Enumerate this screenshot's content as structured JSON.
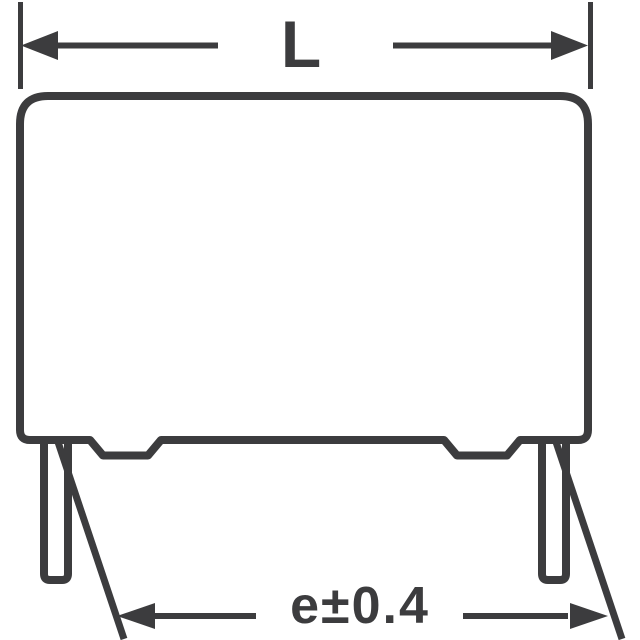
{
  "colors": {
    "line": "#3c3c3e",
    "background": "#ffffff"
  },
  "dimensions": {
    "length_label": "L",
    "pitch_label": "e±0.4"
  }
}
